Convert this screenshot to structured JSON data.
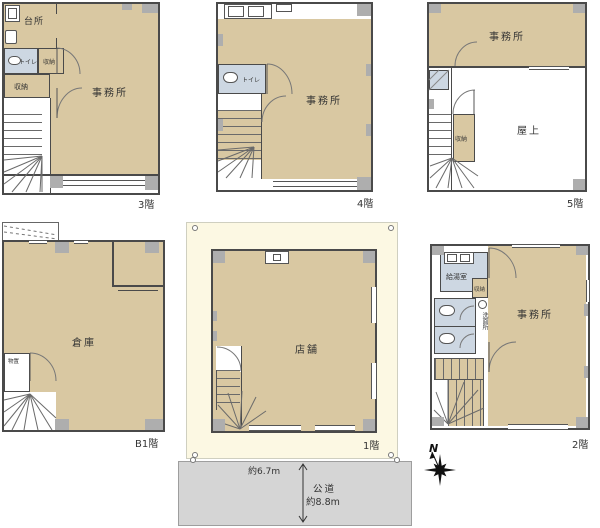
{
  "floors": {
    "f3": {
      "label": "3階",
      "kitchen": "台所",
      "toilet": "トイレ",
      "storage_a": "収納",
      "storage_b": "収納",
      "office": "事務所"
    },
    "f4": {
      "label": "4階",
      "toilet": "トイレ",
      "office": "事務所"
    },
    "f5": {
      "label": "5階",
      "office": "事務所",
      "storage": "収納",
      "rooftop": "屋上"
    },
    "b1": {
      "label": "B1階",
      "warehouse": "倉庫",
      "storeroom": "物置"
    },
    "f1": {
      "label": "1階",
      "shop": "店舗"
    },
    "f2": {
      "label": "2階",
      "kitchenette": "給湯室",
      "storage": "収納",
      "washroom": "洗面所",
      "office": "事務所"
    }
  },
  "site": {
    "frontage": "約6.7m",
    "road": "公道",
    "road_width": "約8.8m",
    "north": "N"
  },
  "colors": {
    "room_fill": "#d9c8a2",
    "wet_area_fill": "#cdd7e2",
    "wall": "#4a4a4a",
    "pillar": "#aeaeae",
    "lot_fill": "#fcf8e3",
    "road_fill": "#d5d5d5"
  }
}
